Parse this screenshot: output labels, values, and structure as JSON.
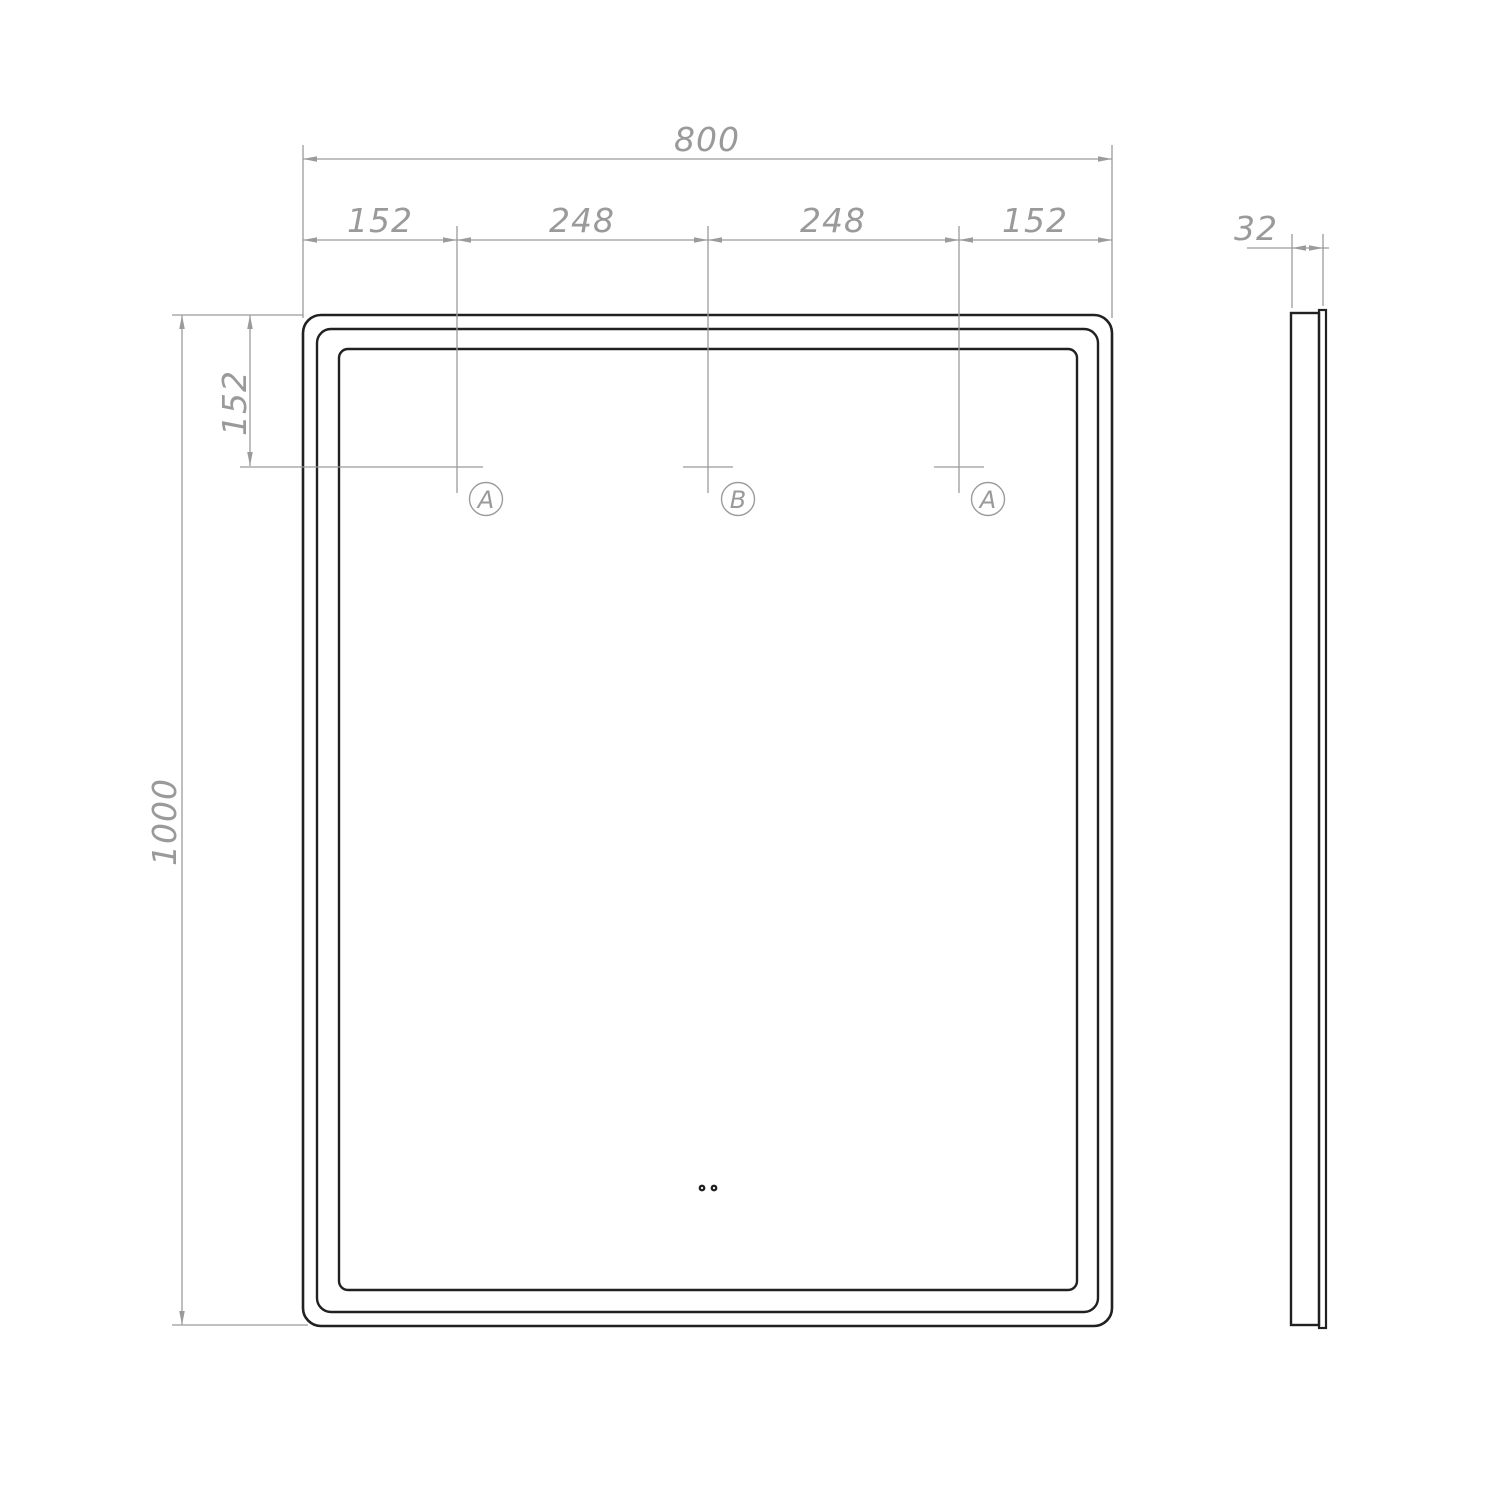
{
  "drawing": {
    "front_view": {
      "total_width": "800",
      "top_segments": [
        "152",
        "248",
        "248",
        "152"
      ],
      "total_height": "1000",
      "mount_offset_top": "152",
      "mount_points": [
        "A",
        "B",
        "A"
      ]
    },
    "side_view": {
      "thickness": "32"
    }
  },
  "colors": {
    "outline": "#212121",
    "dimension": "#9b9b9b",
    "background": "#ffffff"
  }
}
